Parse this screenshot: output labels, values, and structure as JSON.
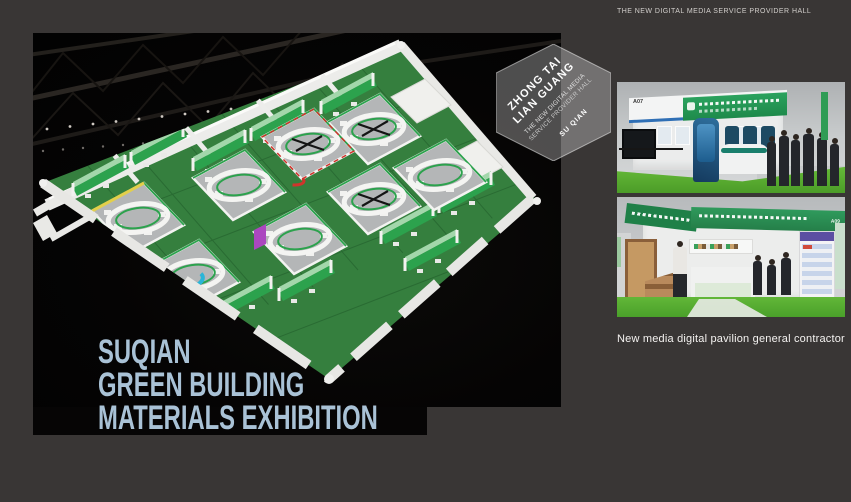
{
  "page": {
    "background_color": "#393635"
  },
  "top_bar": {
    "label": "THE NEW DIGITAL MEDIA SERVICE PROVIDER HALL"
  },
  "badge": {
    "company_line1": "ZHONG TAI",
    "company_line2": "LIAN GUANG",
    "subtitle_line1": "THE NEW DIGITAL MEDIA",
    "subtitle_line2": "SERVICE PROVIDER HALL",
    "city": "SU QIAN"
  },
  "hero_title": {
    "line1": "SUQIAN",
    "line2": "GREEN BUILDING",
    "line3": "MATERIALS EXHIBITION",
    "color": "#a9c2d6"
  },
  "floorplan": {
    "floor_color": "#357f3e",
    "booth_accent_green": "#2ca24d",
    "accent_cyan": "#2ab5d8",
    "accent_purple": "#ab47bf",
    "accent_red": "#d0342c",
    "accent_yellow": "#e2cf4b",
    "wall_color": "#ececea"
  },
  "photos": [
    {
      "booth_label": "A07",
      "description": "Blue and white digital media exhibition booth with green carpet and visitors"
    },
    {
      "booth_label": "A09",
      "description": "Green building materials booth with wood sample displays and visitors"
    }
  ],
  "caption": "New media digital pavilion general contractor"
}
